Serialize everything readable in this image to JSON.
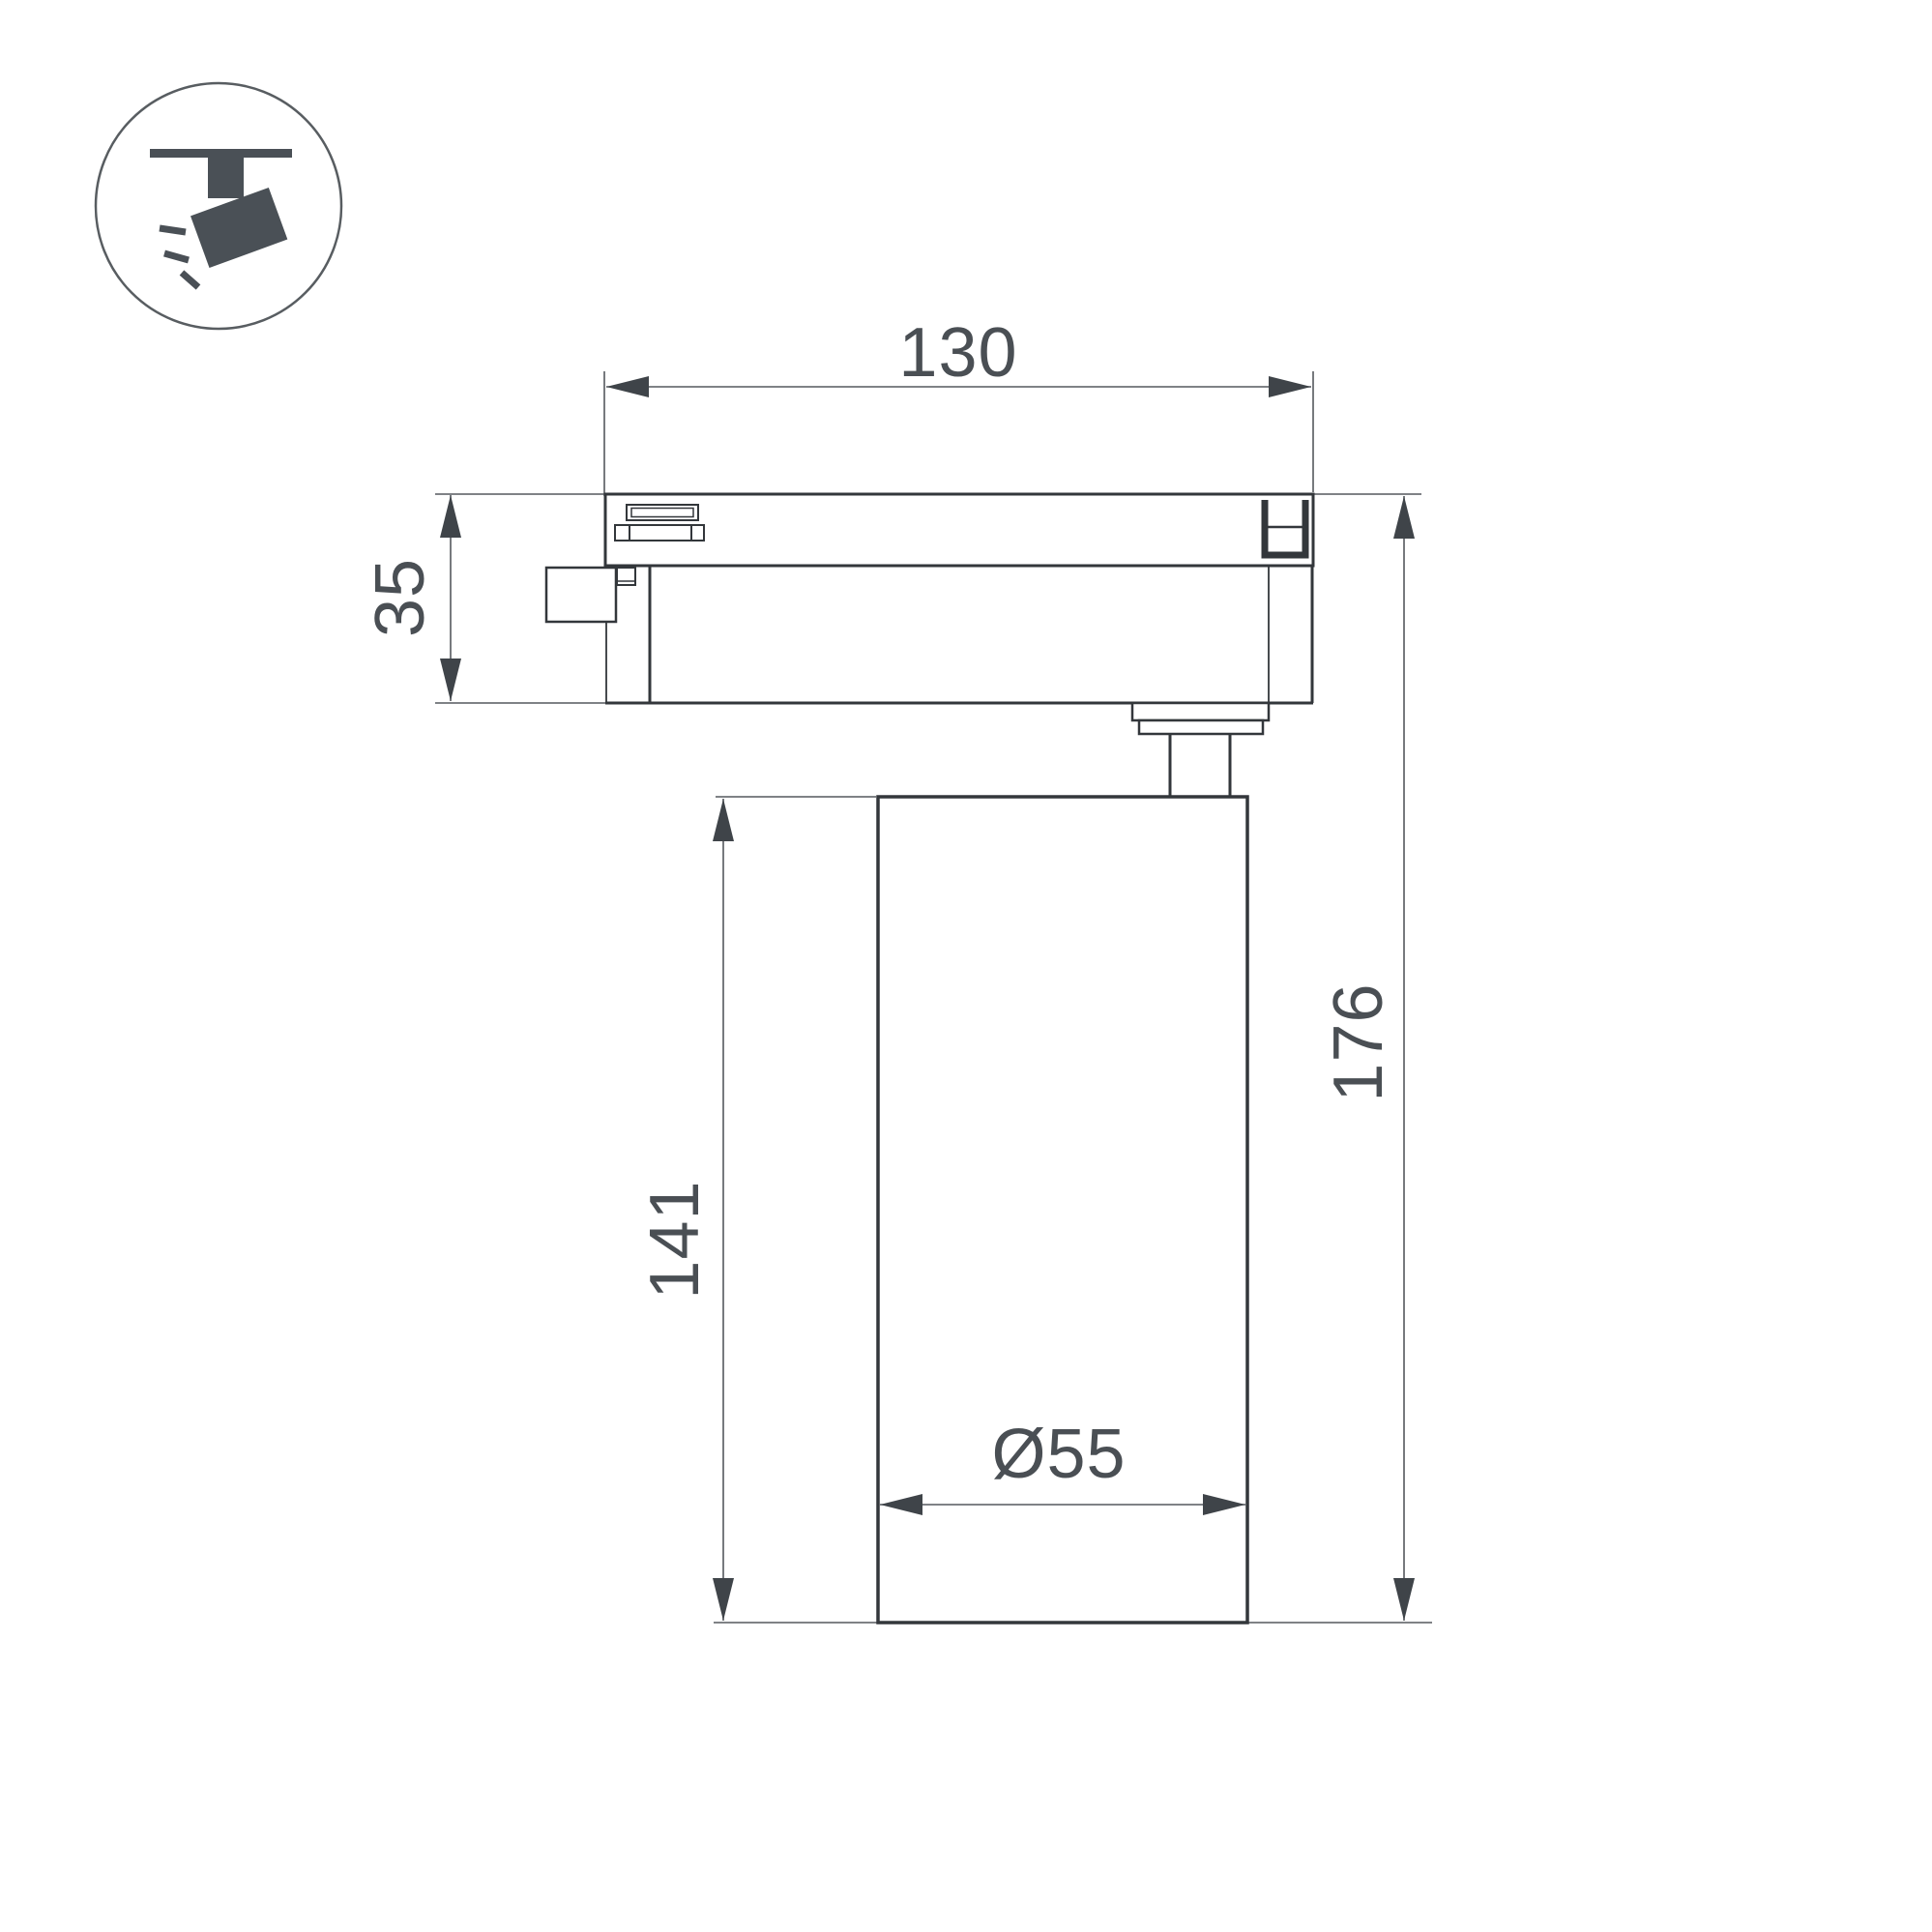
{
  "page": {
    "background": "#ffffff"
  },
  "colors": {
    "outline": "#33373b",
    "thin_line": "#55595e",
    "arrow": "#3f4449",
    "text": "#4a4f54",
    "icon_glyph": "#4a5056",
    "icon_circle": "#585d61"
  },
  "icon": {
    "name": "track-spotlight-icon"
  },
  "dimensions": {
    "track_width": {
      "label": "130"
    },
    "adapter_height": {
      "label": "35"
    },
    "body_height": {
      "label": "141"
    },
    "total_height": {
      "label": "176"
    },
    "diameter": {
      "label": "Ø55"
    }
  }
}
